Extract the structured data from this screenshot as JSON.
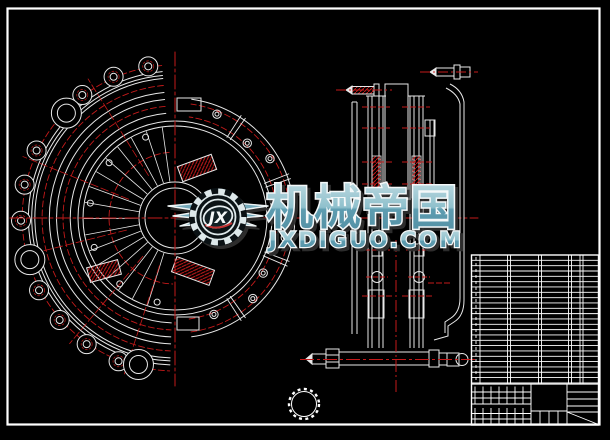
{
  "watermark": {
    "brand": "机械帝国",
    "domain": "JXDIGUO.COM",
    "monogram": "JX"
  },
  "colors": {
    "background": "#000000",
    "frame": "#ffffff",
    "line": "#e8e8e8",
    "centerline_red": "#c41a1a",
    "watermark_teal": "#74a9ba",
    "watermark_teal_dark": "#5b97ab",
    "watermark_outline": "#f4f8f9",
    "watermark_shadow": "#2e2e2e"
  },
  "icons": {
    "gear_icon": "gear emblem in watermark",
    "wings_icon": "spread wings beside gear"
  },
  "drawing": {
    "description_views": {
      "front_view": "clutch cover / driven disc front view",
      "section_view": "clutch assembly side section",
      "bom_table": "parts list table",
      "title_block": "title block",
      "hub_detail": "splined hub small detail circle"
    }
  }
}
